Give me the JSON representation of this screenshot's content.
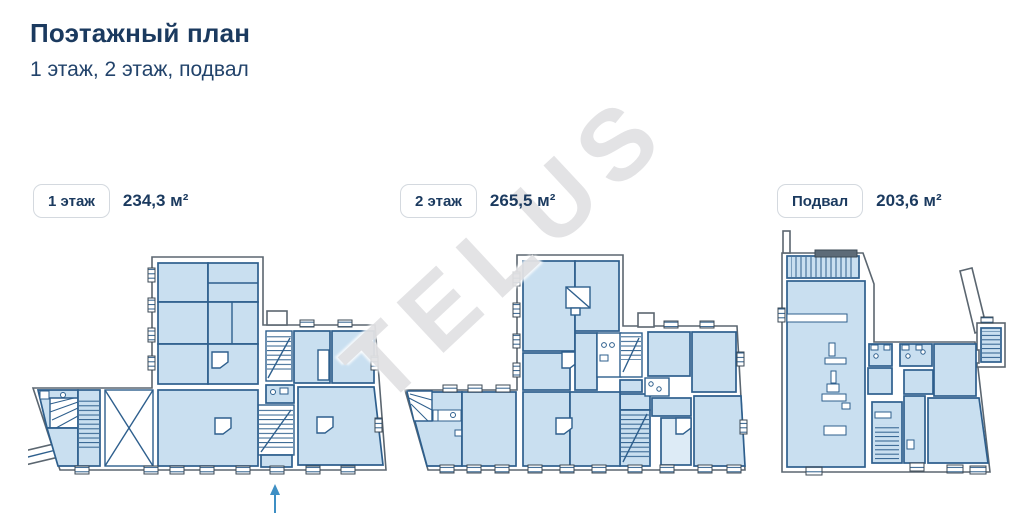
{
  "page": {
    "title": "Поэтажный план",
    "subtitle": "1 этаж, 2 этаж, подвал"
  },
  "watermark": {
    "text": "TELUS"
  },
  "floors": [
    {
      "id": "floor-1",
      "label": "1 этаж",
      "area": "234,3 м²"
    },
    {
      "id": "floor-2",
      "label": "2 этаж",
      "area": "265,5 м²"
    },
    {
      "id": "basement",
      "label": "Подвал",
      "area": "203,6 м²"
    }
  ],
  "colors": {
    "heading": "#1b3a5f",
    "room_fill": "#c9dff0",
    "room_fill_light": "#ddebf6",
    "room_stroke": "#2e5f8d",
    "wall_stroke": "#5b6670",
    "stair_dark_fill": "#5d6b78",
    "entrance_arrow": "#3e8fc4",
    "chip_border": "#d4d9df",
    "watermark_gray": "#e2e2e4"
  }
}
